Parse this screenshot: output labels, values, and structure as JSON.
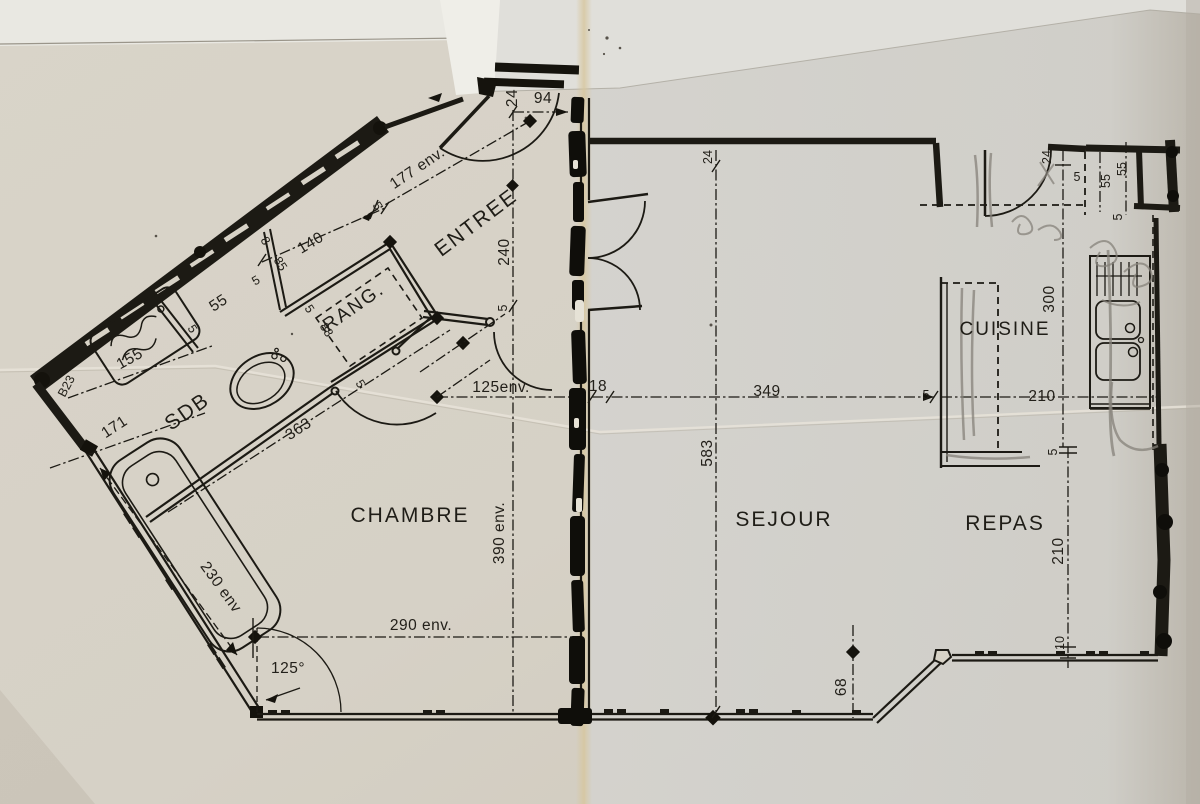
{
  "document_type": "scanned apartment floor plan (photocopy, folded paper)",
  "palette": {
    "paper_left": "#d7d2c6",
    "paper_right": "#d3d2ce",
    "paper_top_strip": "#e9e8e2",
    "ink": "#1c1a14",
    "pencil": "#85827a",
    "fold_tint": "#d7c69c",
    "fold_streak": "#0f0e0a"
  },
  "rooms": [
    {
      "label": "ENTREE"
    },
    {
      "label": "RANG."
    },
    {
      "label": "SDB"
    },
    {
      "label": "CHAMBRE"
    },
    {
      "label": "SEJOUR"
    },
    {
      "label": "REPAS"
    },
    {
      "label": "CUISINE"
    }
  ],
  "dims": [
    {
      "t": "24"
    },
    {
      "t": "94"
    },
    {
      "t": "177 env."
    },
    {
      "t": "240"
    },
    {
      "t": "5"
    },
    {
      "t": "5"
    },
    {
      "t": "140"
    },
    {
      "t": "8"
    },
    {
      "t": "85"
    },
    {
      "t": "5"
    },
    {
      "t": "55"
    },
    {
      "t": "5"
    },
    {
      "t": "155"
    },
    {
      "t": "B23"
    },
    {
      "t": "171"
    },
    {
      "t": "363"
    },
    {
      "t": "5"
    },
    {
      "t": "88"
    },
    {
      "t": "5"
    },
    {
      "t": "125env."
    },
    {
      "t": "18"
    },
    {
      "t": "349"
    },
    {
      "t": "5"
    },
    {
      "t": "210"
    },
    {
      "t": "583"
    },
    {
      "t": "24"
    },
    {
      "t": "390 env."
    },
    {
      "t": "290 env."
    },
    {
      "t": "230 env"
    },
    {
      "t": "125°"
    },
    {
      "t": "68"
    },
    {
      "t": "10"
    },
    {
      "t": "210"
    },
    {
      "t": "5"
    },
    {
      "t": "300"
    },
    {
      "t": "24"
    },
    {
      "t": "5"
    },
    {
      "t": "55"
    },
    {
      "t": "55"
    },
    {
      "t": "5"
    }
  ]
}
